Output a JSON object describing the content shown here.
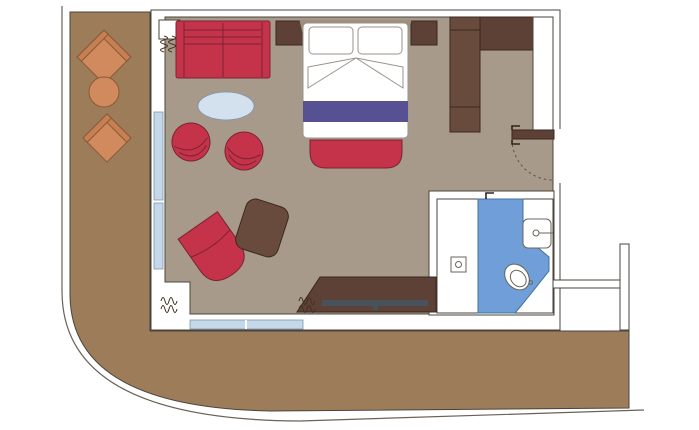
{
  "title": "Stateroom floor plan with balcony",
  "palette": {
    "background": "#ffffff",
    "wall": "#ffffff",
    "wall_outline": "#4a453c",
    "hull_line": "#6a6257",
    "balcony_deck": "#9d7c5a",
    "room_floor": "#a89a8a",
    "bathroom_floor": "#ffffff",
    "wet_area_blue": "#6f9ed9",
    "window_glazing": "#c5d8ea",
    "upholstery_red": "#c5334a",
    "wood_brown": "#684b3d",
    "wood_dark": "#5d4136",
    "balcony_orange": "#d18a5e",
    "balcony_orange_arm": "#c67f52",
    "table_top_blue": "#d3e1ef",
    "bed_runner_purple": "#575093",
    "tv_slate": "#47525c",
    "linen_white": "#ffffff",
    "headboard_tan": "#a18e79"
  },
  "rooms": {
    "balcony": {
      "name": "balcony"
    },
    "living_bedroom": {
      "name": "living / bedroom"
    },
    "bathroom": {
      "name": "bathroom"
    },
    "entry": {
      "name": "entry hall"
    }
  },
  "furniture": {
    "balcony": [
      "armchair",
      "round side table",
      "armchair"
    ],
    "living_bedroom": [
      "sofa",
      "oval coffee table",
      "tub chair",
      "tub chair",
      "lounge chair",
      "ottoman",
      "double bed",
      "pillows",
      "bed runner",
      "foot bench",
      "nightstand",
      "nightstand",
      "wardrobe",
      "desk / TV unit",
      "television"
    ],
    "bathroom": [
      "toilet",
      "washbasin",
      "shower drain"
    ],
    "symbols": [
      "curtain symbol",
      "door swing arc",
      "door pivot marks"
    ]
  }
}
